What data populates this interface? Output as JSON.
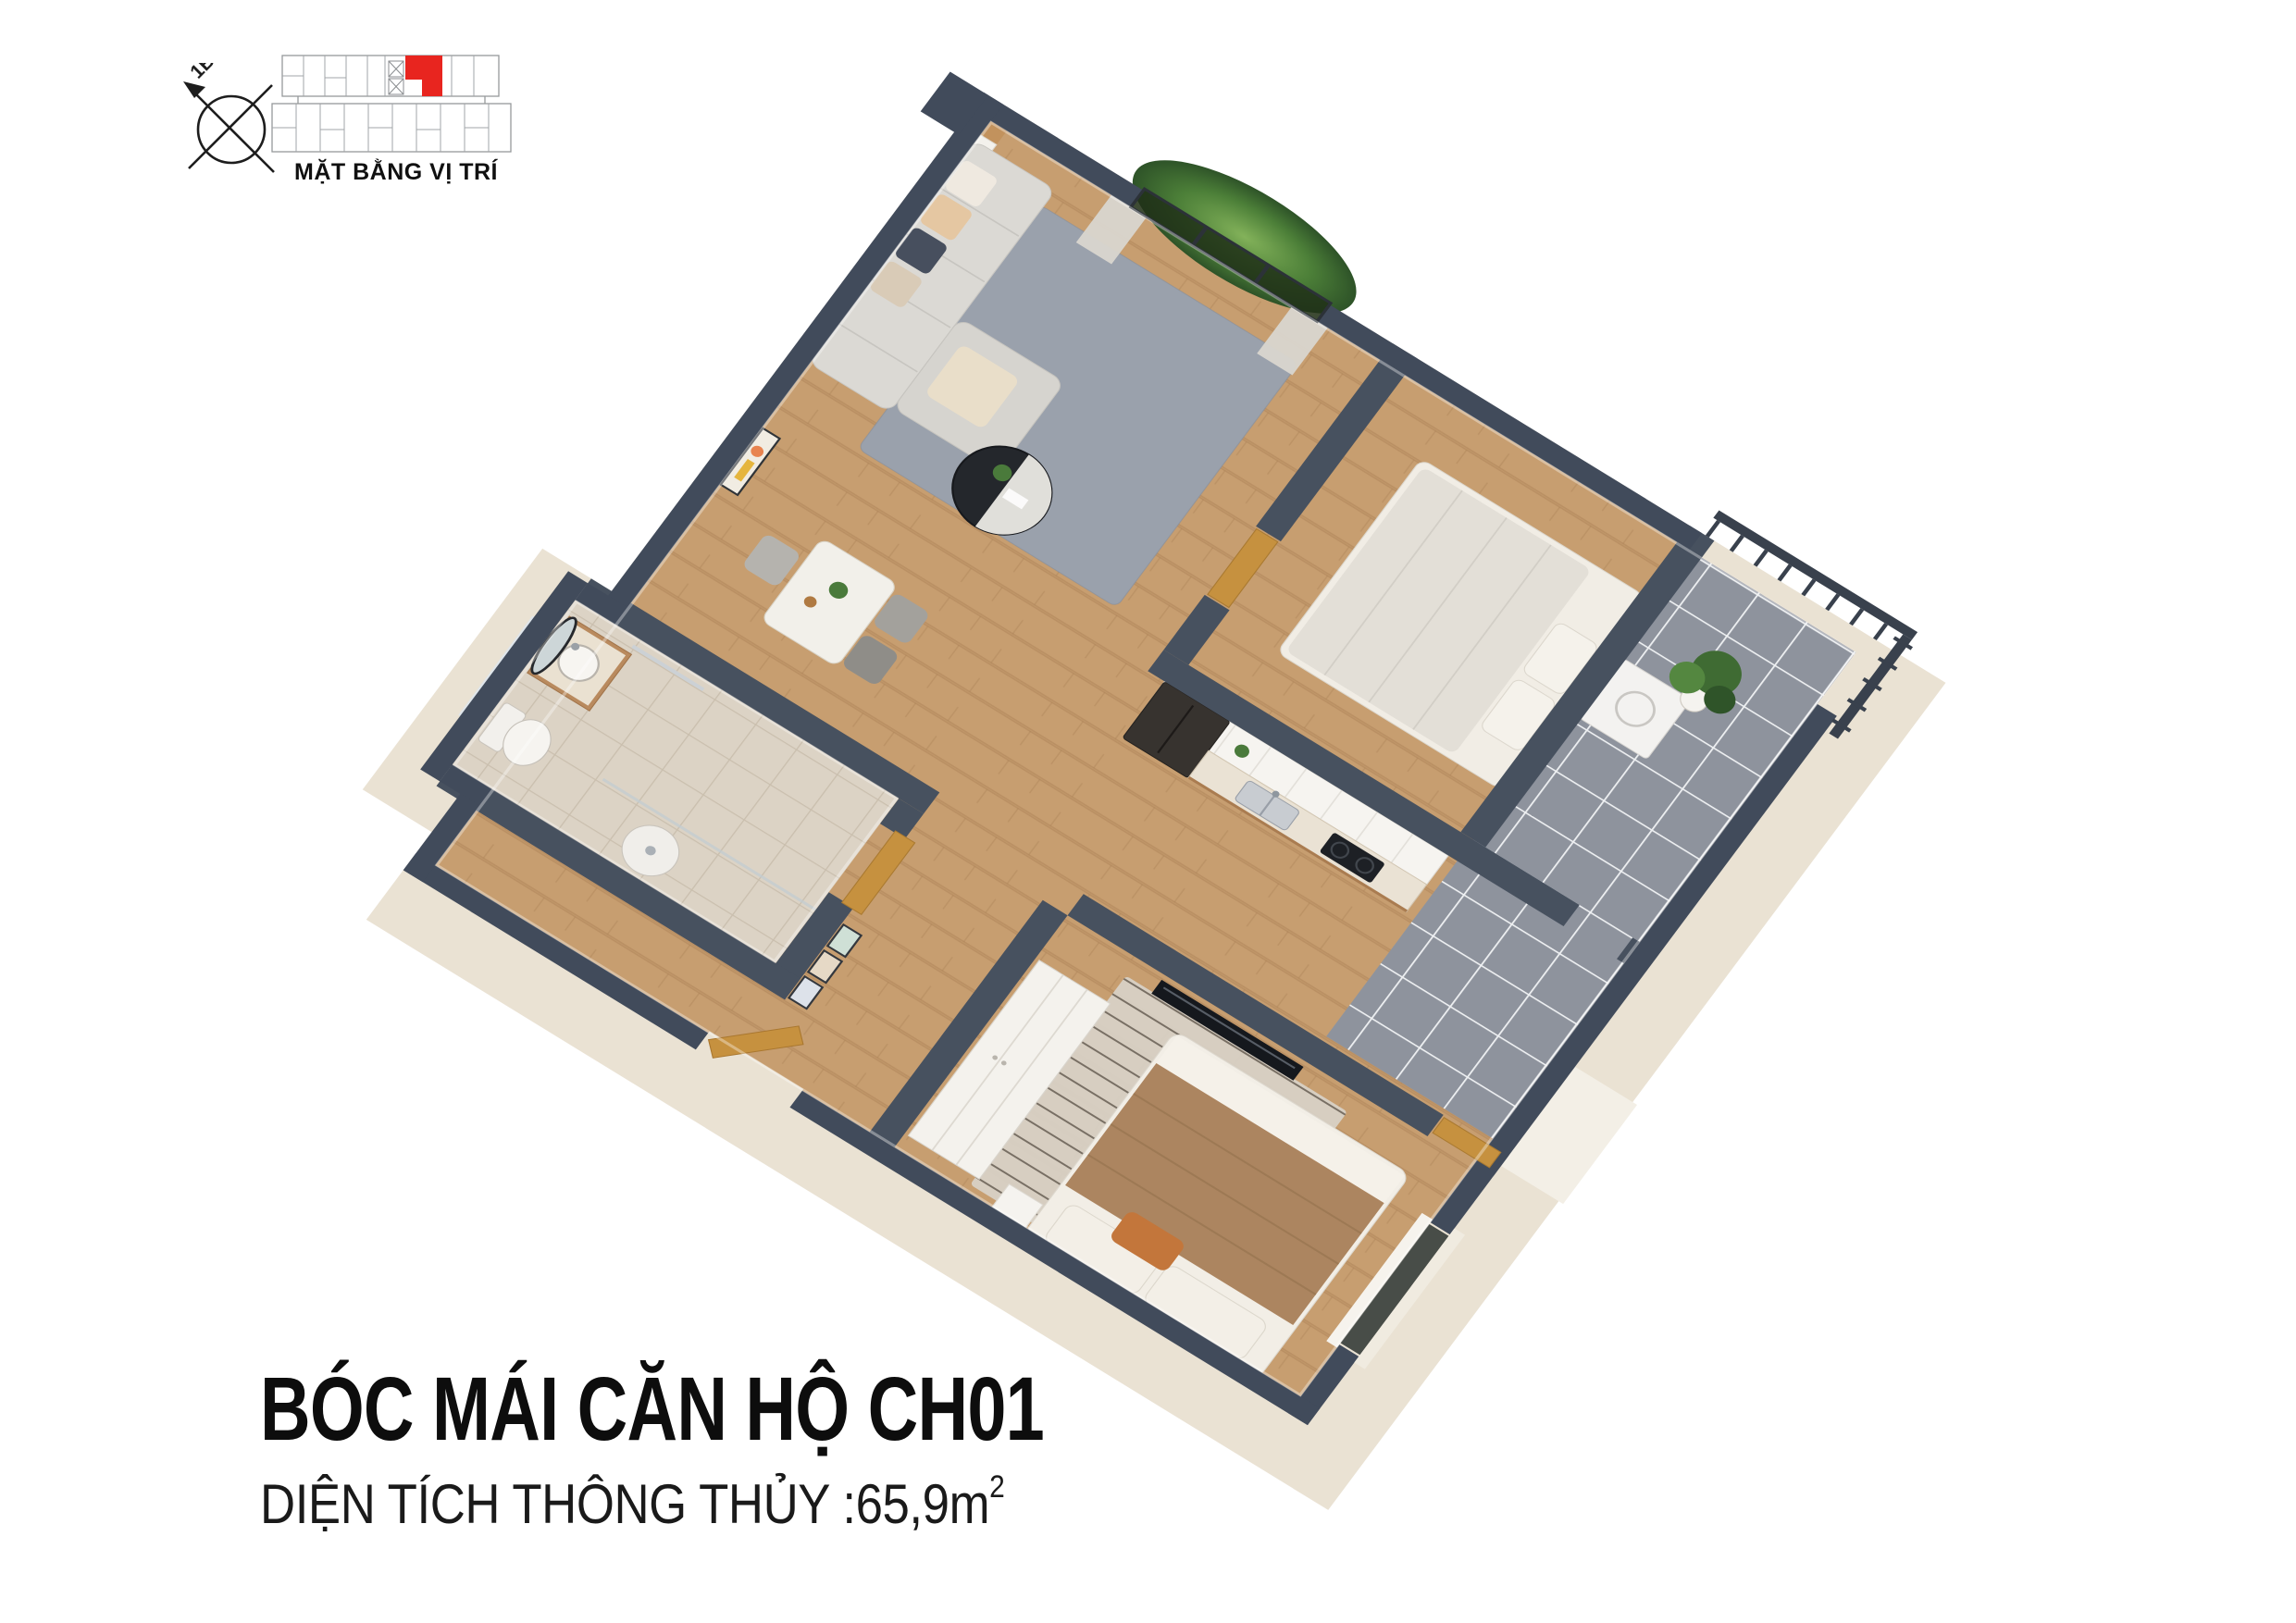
{
  "locator": {
    "label": "MẶT BẰNG VỊ TRÍ",
    "compass_label": "1B",
    "highlight_color": "#e8251f"
  },
  "footer": {
    "title": "BÓC MÁI CĂN HỘ CH01",
    "area_label": "DIỆN TÍCH THÔNG THỦY :65,9m",
    "area_superscript": "2"
  },
  "palette": {
    "wall_exterior": "#414b5b",
    "wall_interior": "#47515f",
    "exterior_face": "#eae2d3",
    "wood_floor": "#c79e70",
    "gray_tile": "#8e939d",
    "bath_tile": "#dcd3c5",
    "rug_gray": "#9aa1ac",
    "greenery": "#4a7a3b",
    "door_wood": "#c6913f",
    "accent_red": "#e8251f",
    "text": "#101010"
  }
}
